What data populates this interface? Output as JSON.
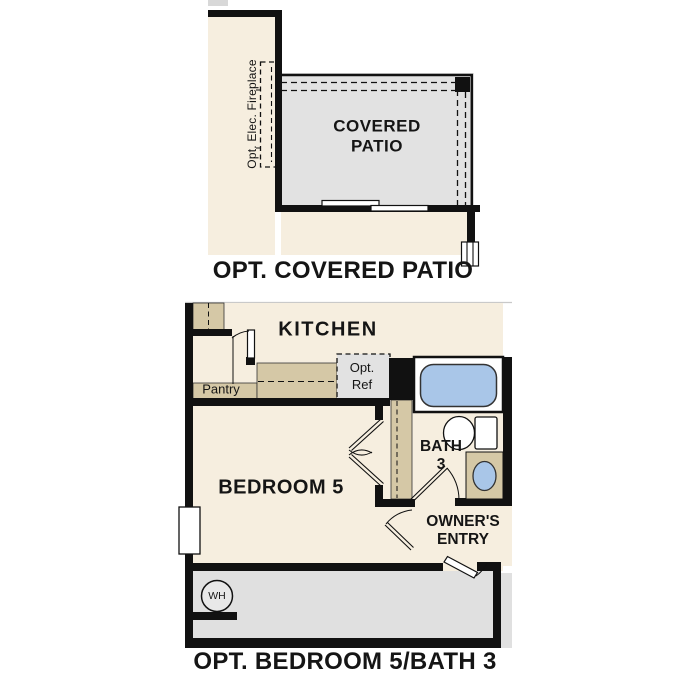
{
  "colors": {
    "wall": "#111111",
    "interior_cream": "#f6eedf",
    "patio_gray": "#e2e2e2",
    "garage_gray": "#e0e0e0",
    "cabinet_tan": "#d5c8a6",
    "fixture_blue": "#a9c6e8"
  },
  "plan_covered_patio": {
    "caption": "OPT. COVERED PATIO",
    "patio_label_line1": "COVERED",
    "patio_label_line2": "PATIO",
    "fireplace_label": "Opt. Elec. Fireplace"
  },
  "plan_bedroom5_bath3": {
    "caption": "OPT. BEDROOM 5/BATH 3",
    "kitchen_label": "KITCHEN",
    "pantry_label": "Pantry",
    "opt_ref_line1": "Opt.",
    "opt_ref_line2": "Ref",
    "bedroom_label": "BEDROOM 5",
    "bath_line1": "BATH",
    "bath_line2": "3",
    "owners_entry_line1": "OWNER'S",
    "owners_entry_line2": "ENTRY",
    "water_heater_label": "WH"
  }
}
